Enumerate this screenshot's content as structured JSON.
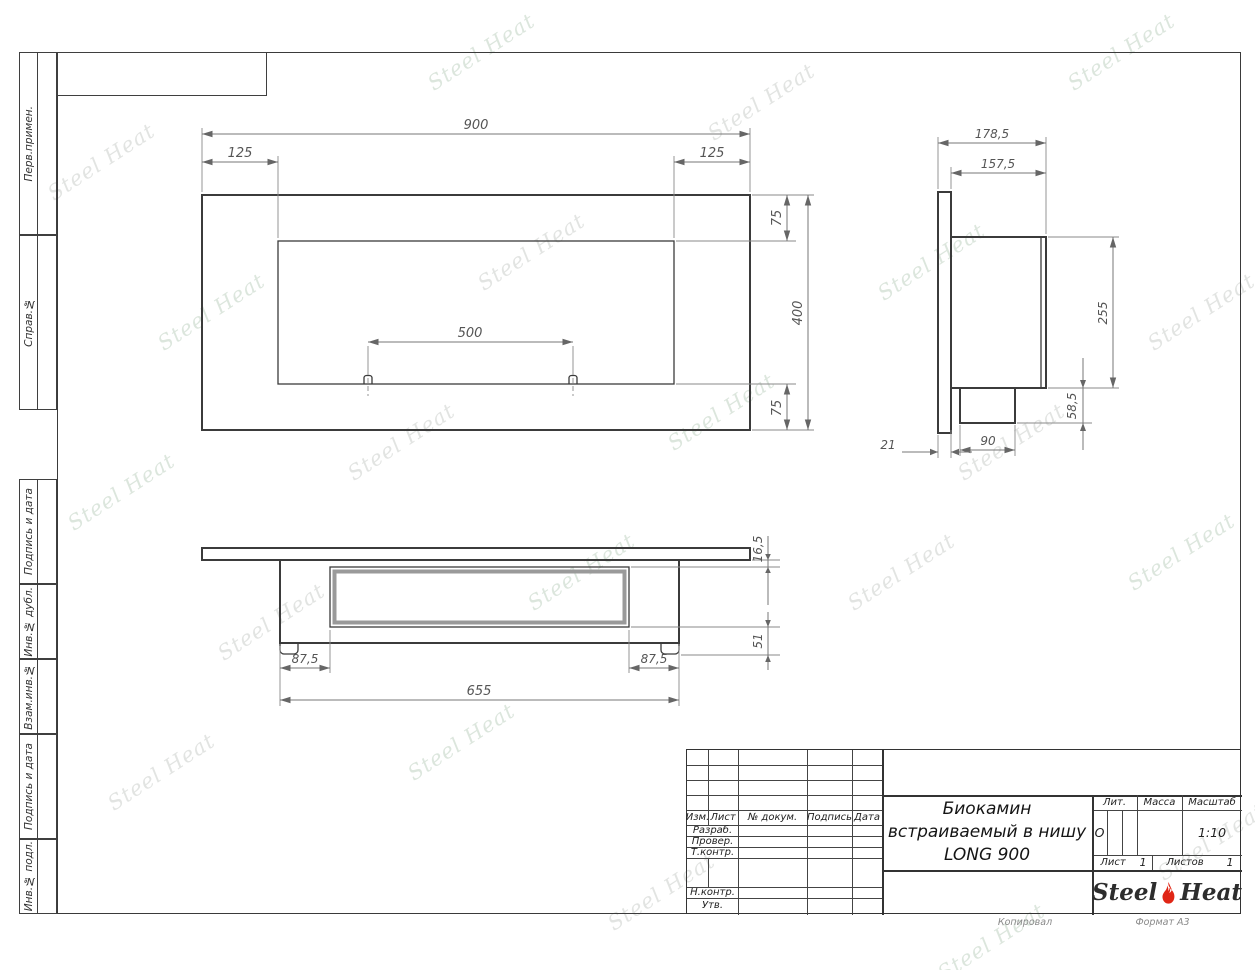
{
  "drawing_title": {
    "line1": "Биокамин",
    "line2": "встраиваемый в нишу",
    "line3": "LONG 900"
  },
  "margin_labels": {
    "perv": "Перв.примен.",
    "sprav": "Справ.№",
    "podpis1": "Подпись и дата",
    "inv_dubl": "Инв.№ дубл.",
    "vzam": "Взам.инв.№",
    "podpis2": "Подпись и дата",
    "inv_podl": "Инв.№ подл."
  },
  "title_block": {
    "izm": "Изм.",
    "list": "Лист",
    "doc": "№ докум.",
    "podpis": "Подпись",
    "data": "Дата",
    "razrab": "Разраб.",
    "prover": "Провер.",
    "tkontr": "Т.контр.",
    "nkontr": "Н.контр.",
    "utv": "Утв.",
    "lit_label": "Лит.",
    "lit_value": "О",
    "massa_label": "Масса",
    "scale_label": "Масштаб",
    "scale_value": "1:10",
    "sheet_label": "Лист",
    "sheet_value": "1",
    "sheets_label": "Листов",
    "sheets_value": "1"
  },
  "logo": {
    "steel": "Steel",
    "heat": "Heat",
    "flame_color": "#e02616"
  },
  "footer": {
    "copied": "Копировал",
    "format": "Формат А3"
  },
  "watermark": {
    "text": "Steel Heat"
  },
  "views": {
    "front": {
      "width": "900",
      "flange_left": "125",
      "flange_right": "125",
      "margin_top": "75",
      "height": "400",
      "margin_bottom": "75",
      "burner_spacing": "500"
    },
    "side": {
      "depth_total": "178,5",
      "depth_body": "157,5",
      "height_body": "255",
      "tray_height": "58,5",
      "tray_depth": "90",
      "flange_thickness": "21"
    },
    "bottom": {
      "flange_gap": "16,5",
      "tray_drop": "51",
      "offset_left": "87,5",
      "offset_right": "87,5",
      "body_width": "655"
    }
  }
}
